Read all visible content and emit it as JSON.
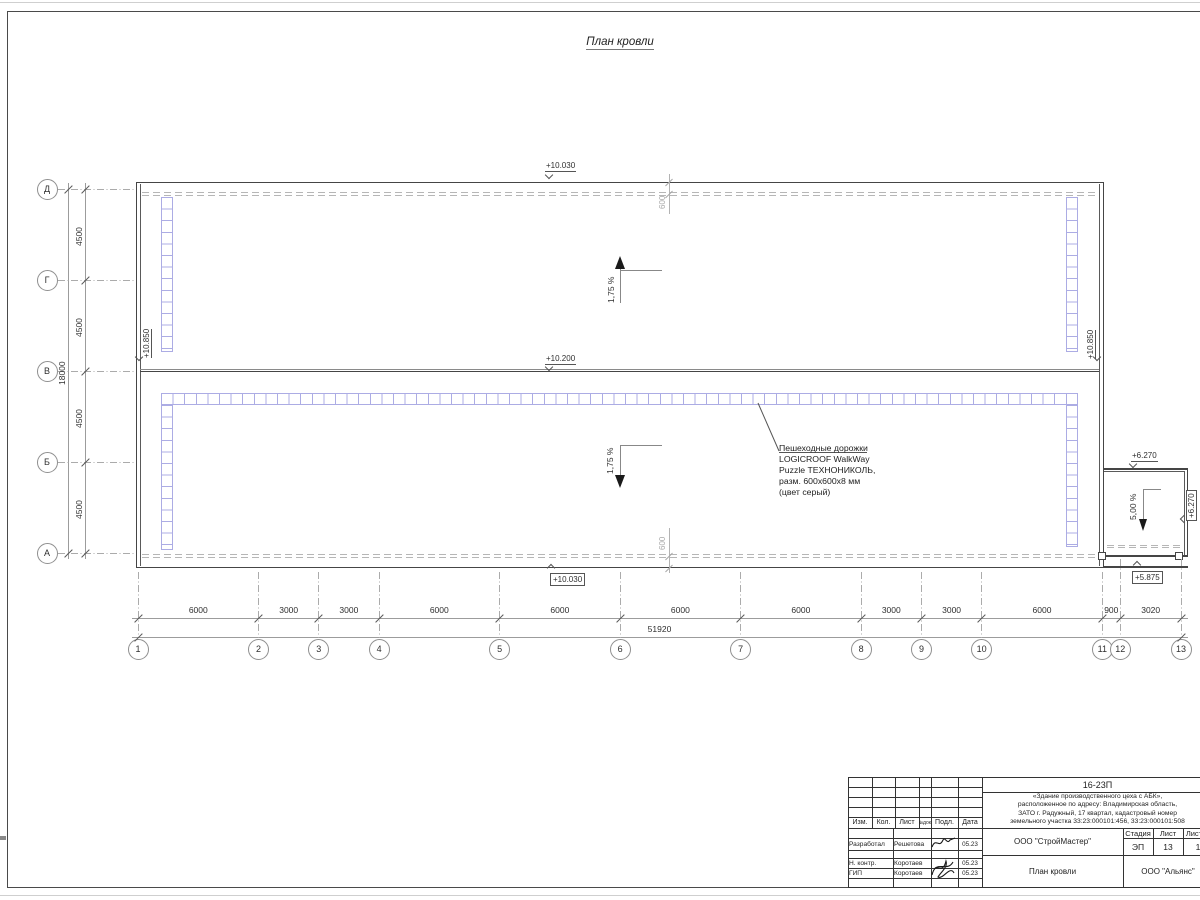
{
  "page": {
    "title": "План кровли"
  },
  "grid": {
    "column_axes": [
      "1",
      "2",
      "3",
      "4",
      "5",
      "6",
      "7",
      "8",
      "9",
      "10",
      "11",
      "12",
      "13"
    ],
    "column_spans_mm": [
      6000,
      3000,
      3000,
      6000,
      6000,
      6000,
      6000,
      3000,
      3000,
      6000,
      900,
      3020
    ],
    "row_axes": [
      "Д",
      "Г",
      "В",
      "Б",
      "А"
    ],
    "row_spans_mm": [
      4500,
      4500,
      4500,
      4500
    ]
  },
  "dimension_labels": {
    "bottom_segments": [
      "6000",
      "3000",
      "3000",
      "6000",
      "6000",
      "6000",
      "6000",
      "3000",
      "3000",
      "6000",
      "900",
      "3020"
    ],
    "bottom_total": "51920",
    "left_segments": [
      "4500",
      "4500",
      "4500",
      "4500"
    ],
    "left_total": "18000",
    "parapet_top": "600",
    "parapet_bottom": "600"
  },
  "elevations": {
    "roof_top_edge": "+10.030",
    "roof_ridge": "+10.200",
    "roof_bottom_edge": "+10.030",
    "parapet_left": "+10.850",
    "parapet_right": "+10.850",
    "annex_top": "+6.270",
    "annex_right": "+6.270",
    "annex_bottom": "+5.875"
  },
  "slopes": {
    "upper_roof": "1,75 %",
    "lower_roof": "1,75 %",
    "annex_roof": "5,00 %"
  },
  "walkway_note": {
    "lines": [
      "Пешеходные дорожки",
      "LOGICROOF WalkWay",
      "Puzzle ТЕХНОНИКОЛЬ,",
      "разм. 600х600х8 мм",
      "(цвет серый)"
    ]
  },
  "title_block": {
    "project_code": "16-23П",
    "description_lines": [
      "«Здание производственного цеха с АБК»,",
      "расположенное по адресу: Владимирская область,",
      "ЗАТО г. Радужный, 17 квартал, кадастровый номер",
      "земельного участка 33:23:000101:456, 33:23:000101:508"
    ],
    "columns_header": [
      "Изм.",
      "Кол.",
      "Лист",
      "№док.",
      "Подл.",
      "Дата"
    ],
    "rows": [
      {
        "role": "Разработал",
        "name": "Решетова",
        "date": "05.23"
      },
      {
        "role": "Н. контр.",
        "name": "Коротаев",
        "date": "05.23"
      },
      {
        "role": "ГИП",
        "name": "Коротаев",
        "date": "05.23"
      }
    ],
    "stage_label": "Стадия",
    "stage_value": "ЭП",
    "sheet_label": "Лист",
    "sheet_value": "13",
    "sheets_label": "Листов",
    "sheets_value": "1",
    "designer_org": "ООО \"СтройМастер\"",
    "sheet_title": "План кровли",
    "client_org": "ООО \"Альянс\""
  },
  "colors": {
    "walkway_accent": "#acace4",
    "line_dark": "#454545",
    "line_gray": "#9c9c9c"
  }
}
